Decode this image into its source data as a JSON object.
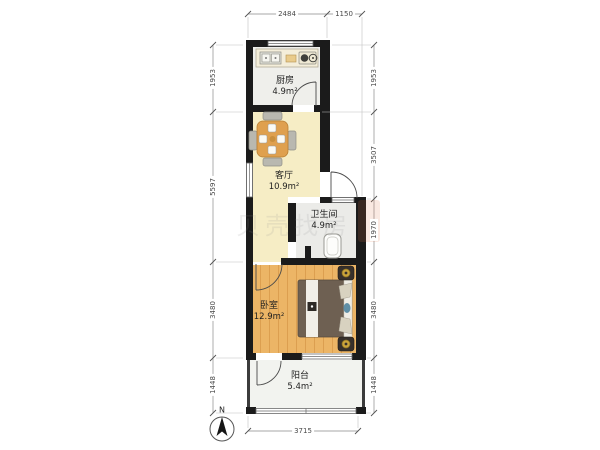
{
  "floorplan": {
    "rooms": {
      "kitchen": {
        "label": "厨房",
        "area": "4.9m²"
      },
      "living_room": {
        "label": "客厅",
        "area": "10.9m²"
      },
      "bathroom": {
        "label": "卫生间",
        "area": "4.9m²"
      },
      "bedroom": {
        "label": "卧室",
        "area": "12.9m²"
      },
      "balcony": {
        "label": "阳台",
        "area": "5.4m²"
      }
    },
    "dimensions_mm": {
      "top": [
        "2484",
        "1150"
      ],
      "left": [
        "1953",
        "5597",
        "3480",
        "1448"
      ],
      "right": [
        "1953",
        "3507",
        "1970",
        "3480",
        "1448"
      ],
      "bottom": [
        "3715"
      ]
    },
    "compass_label": "N",
    "watermark": "贝壳找房",
    "colors": {
      "wall": "#1b1b1b",
      "living_floor": "#f6edc5",
      "kitchen_floor": "#efefeb",
      "bathroom_floor": "#ebebe8",
      "bedroom_floor": "#ecb566",
      "balcony_floor": "#f2f3ef",
      "table_wood": "#dfa04e",
      "bed_duvet": "#6e6052",
      "dimension_text": "#4a4a4a"
    }
  }
}
